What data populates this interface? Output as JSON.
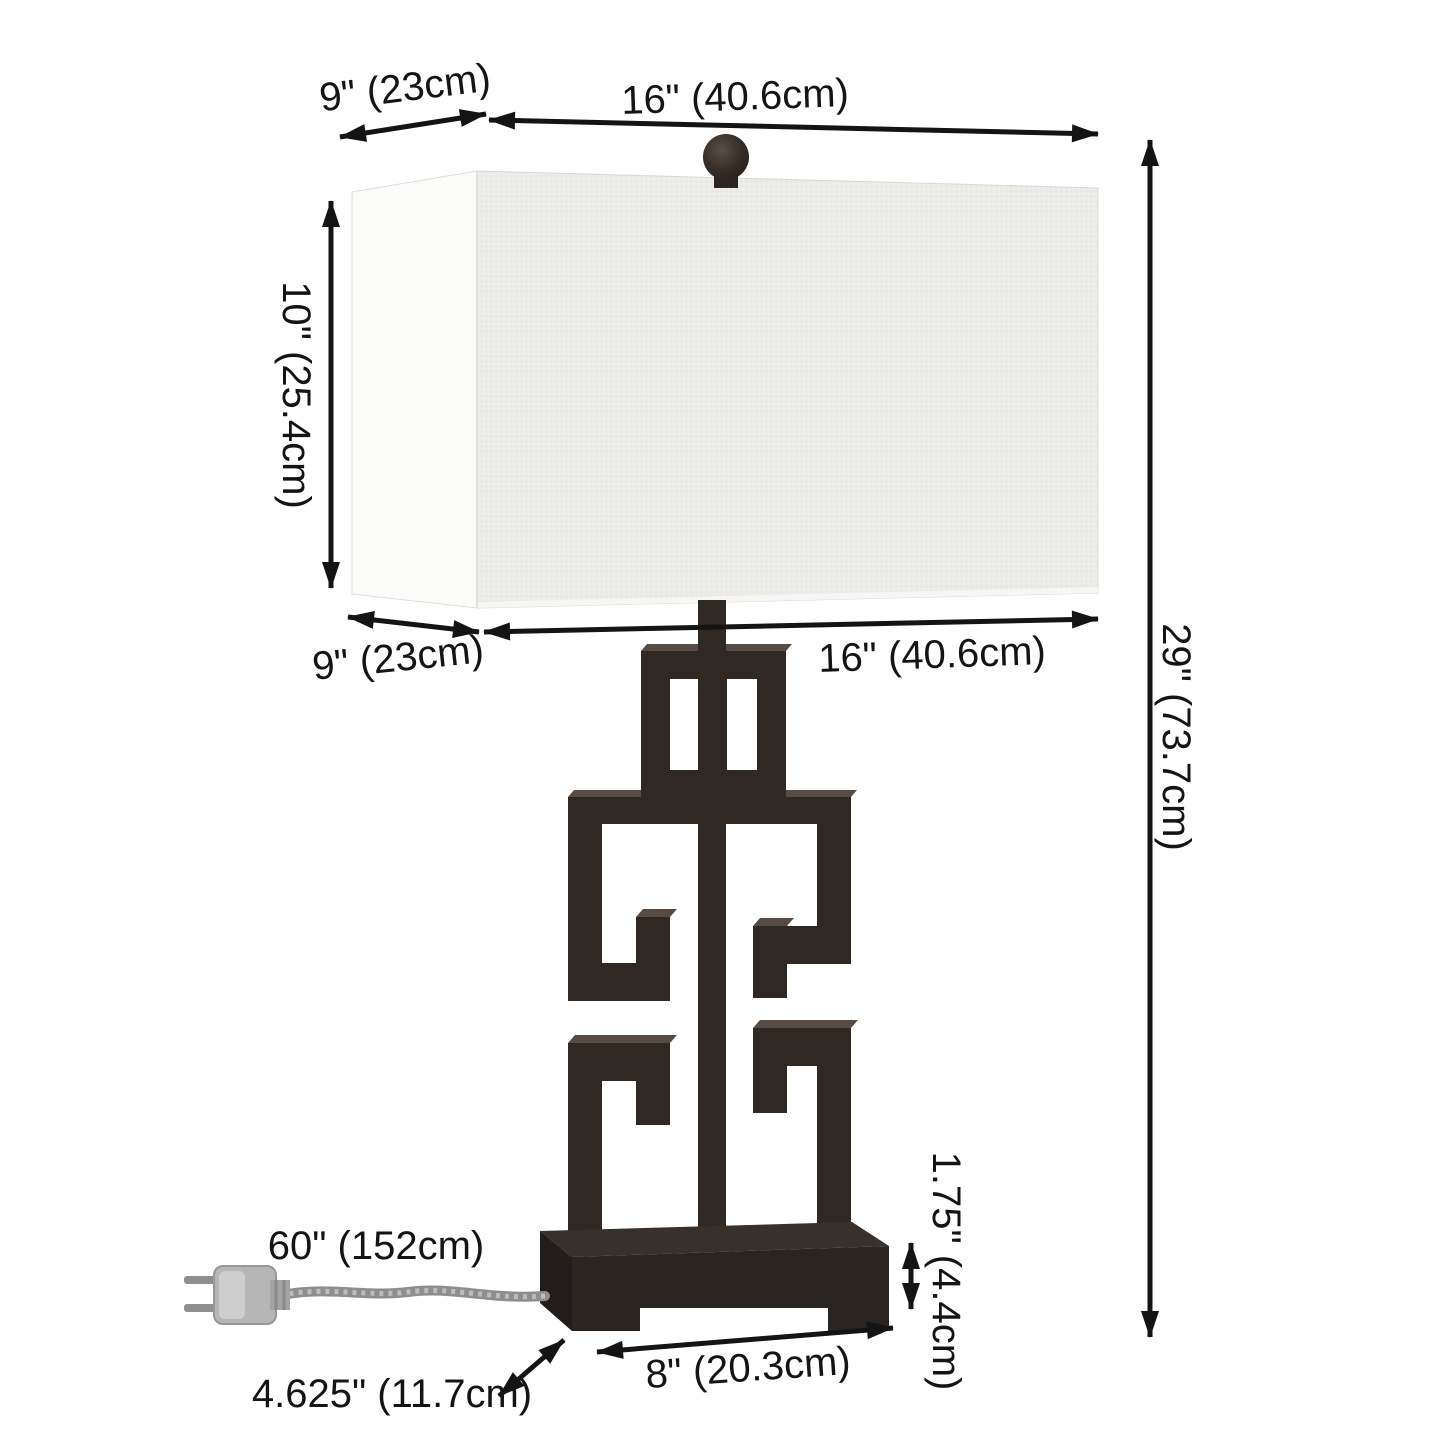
{
  "diagram": {
    "labels": {
      "shade_top_depth": "9\" (23cm)",
      "shade_top_width": "16\" (40.6cm)",
      "shade_height": "10\" (25.4cm)",
      "shade_bottom_depth": "9\" (23cm)",
      "shade_bottom_width": "16\" (40.6cm)",
      "overall_height": "29\" (73.7cm)",
      "cord_length": "60\" (152cm)",
      "base_depth": "4.625\" (11.7cm)",
      "base_width": "8\" (20.3cm)",
      "base_height": "1.75\" (4.4cm)"
    },
    "colors": {
      "background": "#ffffff",
      "arrow": "#141414",
      "label_text": "#141414",
      "shade_front": "#ebebe8",
      "shade_side": "#fbfbfa",
      "body_metal": "#2f2823",
      "body_highlight": "#564c43",
      "base_top": "#38312b",
      "base_front": "#2b2521",
      "base_side": "#221d1a",
      "cord": "#9a9a9a",
      "plug": "#b6b6b6"
    }
  }
}
